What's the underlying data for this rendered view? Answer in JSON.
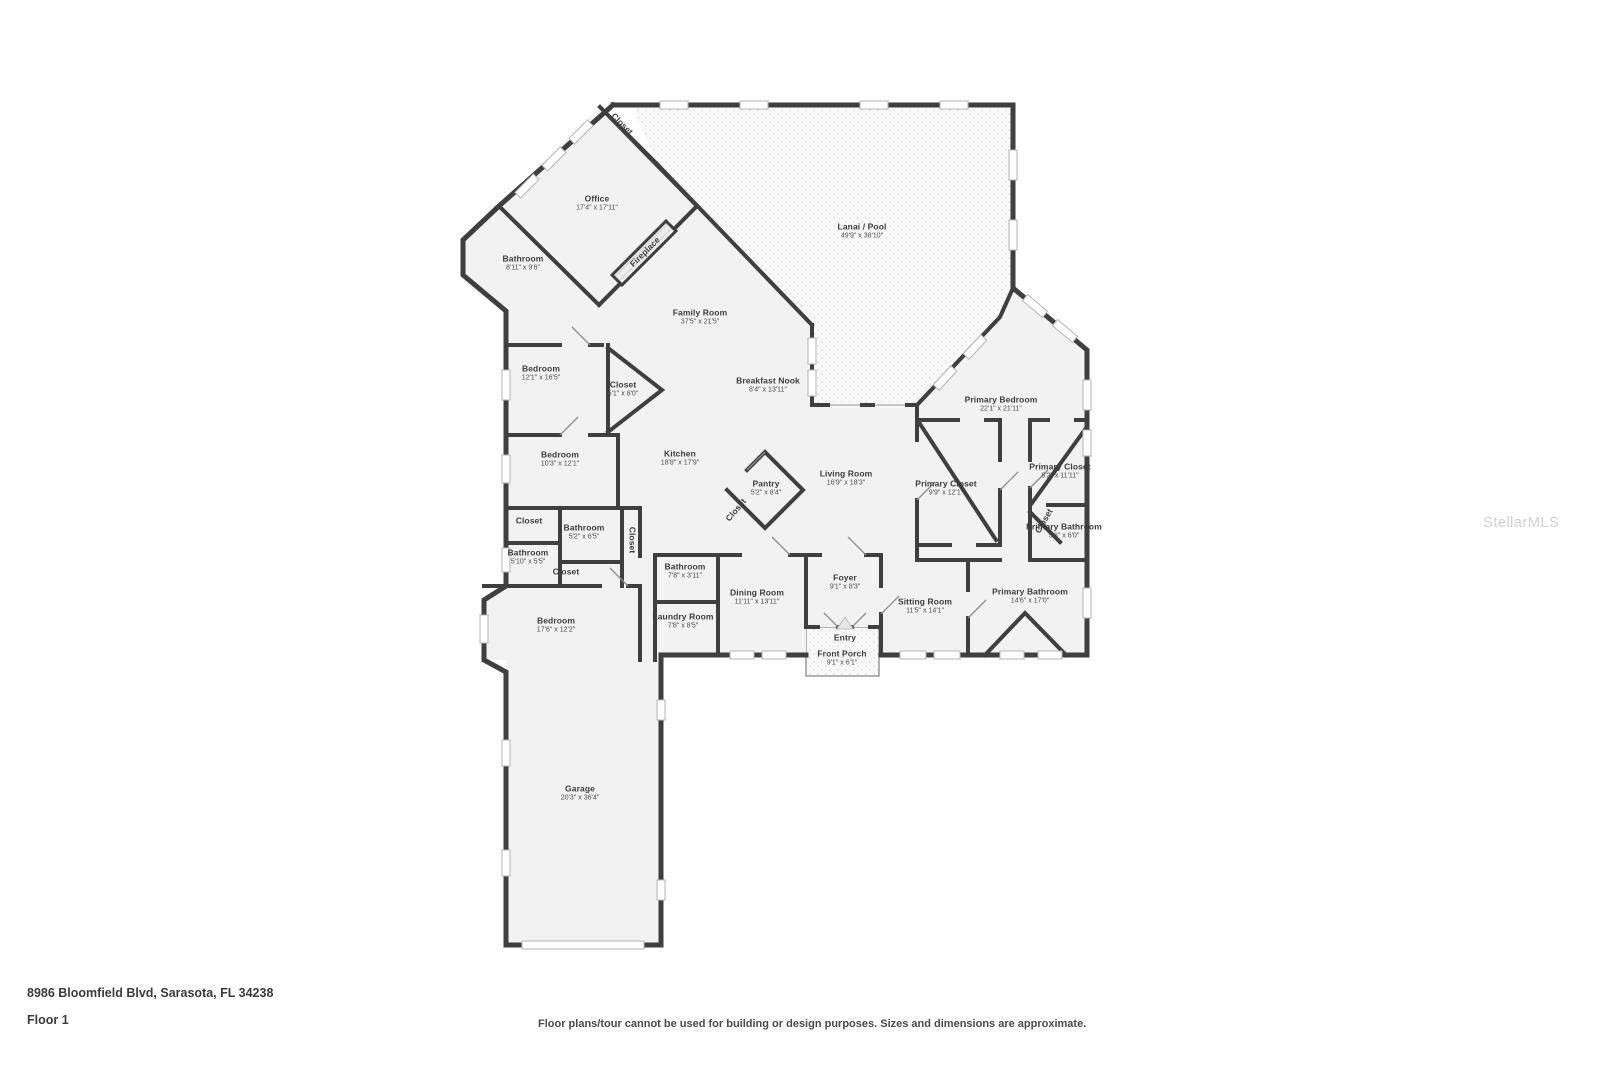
{
  "footer": {
    "address": "8986 Bloomfield Blvd, Sarasota, FL 34238",
    "floor_label": "Floor 1",
    "disclaimer": "Floor plans/tour cannot be used for building or design purposes. Sizes and dimensions are approximate."
  },
  "watermark": "StellarMLS",
  "colors": {
    "wall": "#3f3f3f",
    "room_fill": "#f2f2f2",
    "outdoor_fill": "#f8f8f8",
    "label_text": "#3c3c3c",
    "watermark": "#d2d2d2"
  },
  "rooms": [
    {
      "name": "Closet",
      "dims": ""
    },
    {
      "name": "Office",
      "dims": "17'4\" x 17'11\""
    },
    {
      "name": "Bathroom",
      "dims": "8'11\" x 9'6\""
    },
    {
      "name": "Fireplace",
      "dims": ""
    },
    {
      "name": "Lanai / Pool",
      "dims": "49'9\" x 38'10\""
    },
    {
      "name": "Family Room",
      "dims": "37'5\" x 21'5\""
    },
    {
      "name": "Bedroom",
      "dims": "12'1\" x 16'5\""
    },
    {
      "name": "Closet",
      "dims": "5'1\" x 8'0\""
    },
    {
      "name": "Breakfast Nook",
      "dims": "8'4\" x 13'11\""
    },
    {
      "name": "Primary Bedroom",
      "dims": "22'1\" x 21'11\""
    },
    {
      "name": "Bedroom",
      "dims": "10'3\" x 12'1\""
    },
    {
      "name": "Kitchen",
      "dims": "18'8\" x 17'9\""
    },
    {
      "name": "Pantry",
      "dims": "5'2\" x 8'4\""
    },
    {
      "name": "Closet",
      "dims": ""
    },
    {
      "name": "Living Room",
      "dims": "16'9\" x 18'3\""
    },
    {
      "name": "Primary Closet",
      "dims": "9'9\" x 12'1\""
    },
    {
      "name": "Primary Closet",
      "dims": "8'2\" x 11'11\""
    },
    {
      "name": "Closet",
      "dims": ""
    },
    {
      "name": "Bathroom",
      "dims": "5'2\" x 6'5\""
    },
    {
      "name": "Bathroom",
      "dims": "5'10\" x 5'5\""
    },
    {
      "name": "Closet",
      "dims": ""
    },
    {
      "name": "Closet",
      "dims": ""
    },
    {
      "name": "Closet",
      "dims": ""
    },
    {
      "name": "Primary Bathroom",
      "dims": "5'6\" x 6'0\""
    },
    {
      "name": "Bathroom",
      "dims": "7'8\" x 3'11\""
    },
    {
      "name": "Dining Room",
      "dims": "11'11\" x 13'11\""
    },
    {
      "name": "Foyer",
      "dims": "9'1\" x 8'3\""
    },
    {
      "name": "Sitting Room",
      "dims": "11'5\" x 14'1\""
    },
    {
      "name": "Primary Bathroom",
      "dims": "14'6\" x 17'0\""
    },
    {
      "name": "Laundry Room",
      "dims": "7'8\" x 8'5\""
    },
    {
      "name": "Bedroom",
      "dims": "17'6\" x 12'2\""
    },
    {
      "name": "Entry",
      "dims": ""
    },
    {
      "name": "Front Porch",
      "dims": "9'1\" x 6'1\""
    },
    {
      "name": "Garage",
      "dims": "20'3\" x 36'4\""
    }
  ]
}
